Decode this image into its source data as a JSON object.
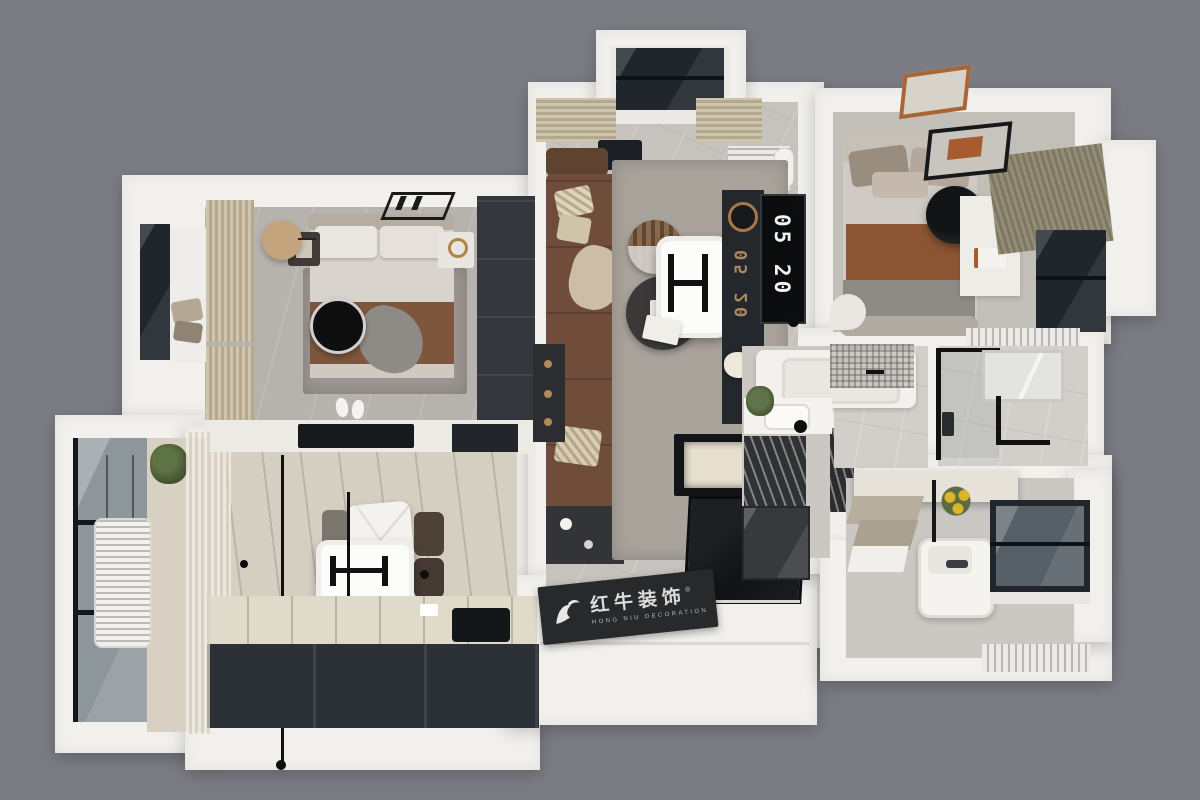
{
  "scene": {
    "type": "3d-floorplan-top-view-render",
    "background_color": "#7c7c84"
  },
  "watermark": {
    "brand_cn": "红牛装饰",
    "brand_en": "HONG NIU DECORATION",
    "registered_mark": "®",
    "icon": "bull-icon"
  },
  "living_room": {
    "tv_clock": "05 20",
    "tv_reflection_digits": "05 20"
  },
  "palette": {
    "background": "#7c7c84",
    "wall_white": "#f1f0ed",
    "floor_living_marble": "#c6c2bd",
    "floor_bedroom": "#b6b2ae",
    "floor_wood_plank": "#d5cfc2",
    "floor_bath_tile": "#d2cfca",
    "kitchen_counter": "#e0dacb",
    "cabinet_dark": "#2c3138",
    "wardrobe_dark": "#33373d",
    "sofa_brown": "#6f4d3a",
    "blanket_brown": "#7d563c",
    "bed2_blanket_rust": "#8c5634",
    "curtain_beige": "#c4b89f",
    "curtain_olive": "#8a846f",
    "rug_gray": "#a8a39b",
    "window_glass_dark": "#20262c",
    "tv_black": "#0a0c0e",
    "plaque_dark": "#28292b",
    "clock_digits_white": "#f2f2f2",
    "reflection_bronze": "#c59a6a",
    "plant_green": "#4f6138",
    "flower_yellow": "#d9b62b"
  }
}
